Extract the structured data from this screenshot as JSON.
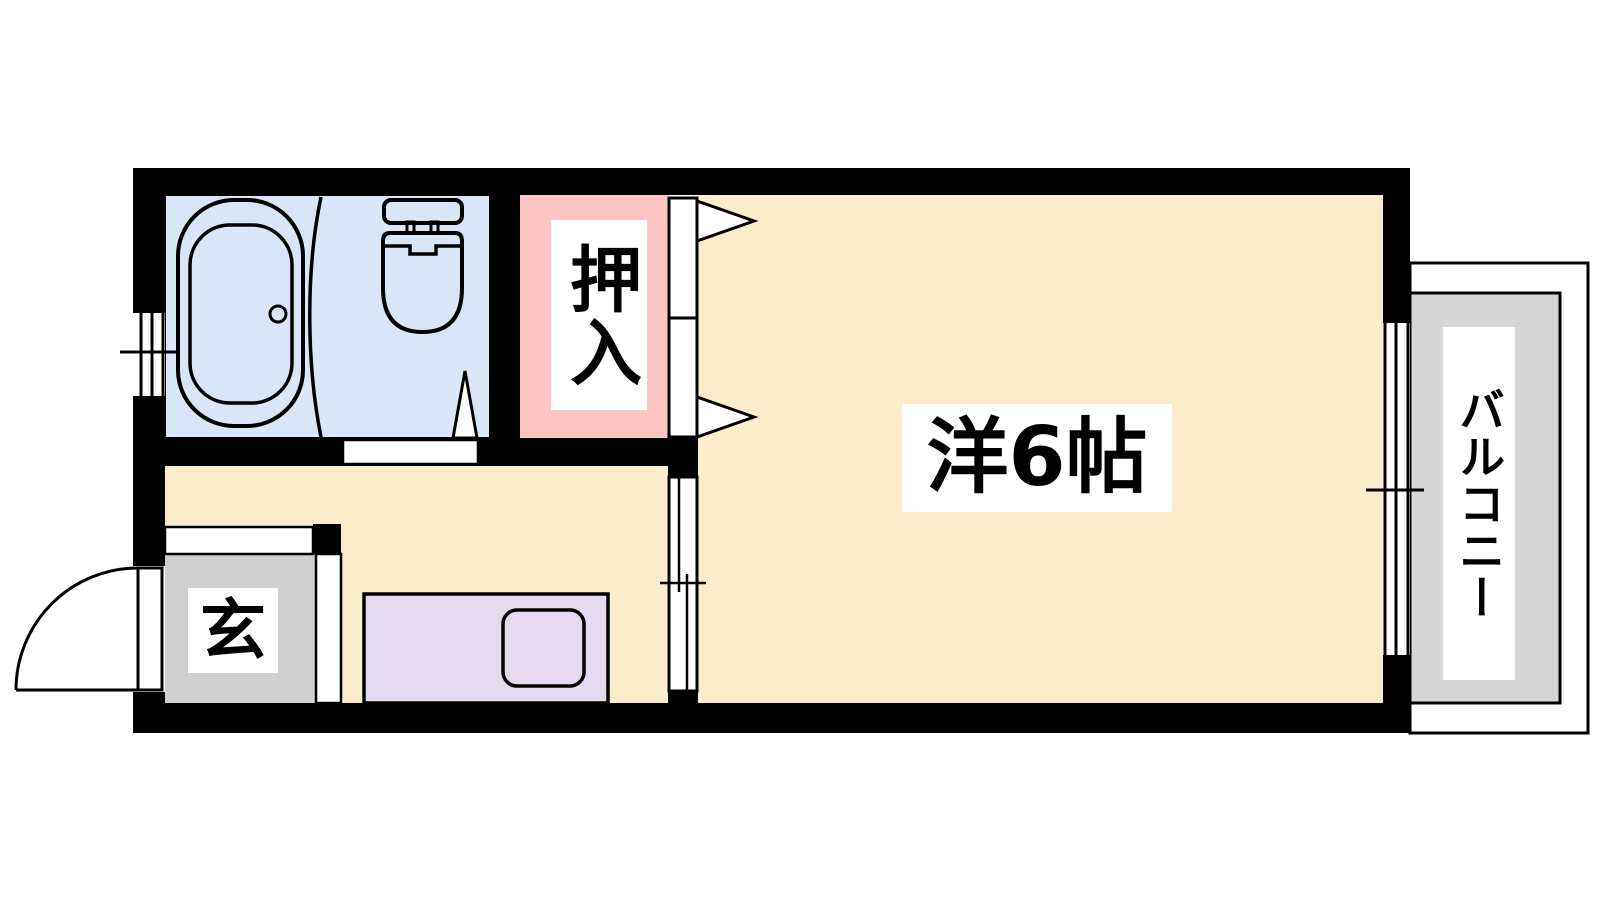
{
  "plan": {
    "type": "apartment-floorplan",
    "rooms": {
      "closet": {
        "label": "押入"
      },
      "genkan": {
        "label": "玄"
      },
      "western_room": {
        "label": "洋6帖"
      },
      "balcony": {
        "label": "バルコニー"
      }
    },
    "colors": {
      "wall": "#000000",
      "bathroom_floor": "#d8e6f7",
      "closet_floor": "#ffc4c4",
      "room_floor": "#fbedcc",
      "genkan_floor": "#d0d0d0",
      "balcony_floor": "#d6d6d6",
      "counter": "#e5d9f0",
      "label_bg": "#ffffff",
      "line": "#000000"
    },
    "fixtures": {
      "bathtub": "bathtub",
      "toilet": "toilet",
      "kitchen_counter": "kitchen-counter-with-sink",
      "entrance_door": "hinged-entrance-door",
      "closet_doors": "sliding-closet-doors",
      "room_divider_door": "sliding-door",
      "left_window": "double-sliding-window",
      "right_window": "double-sliding-window"
    }
  }
}
